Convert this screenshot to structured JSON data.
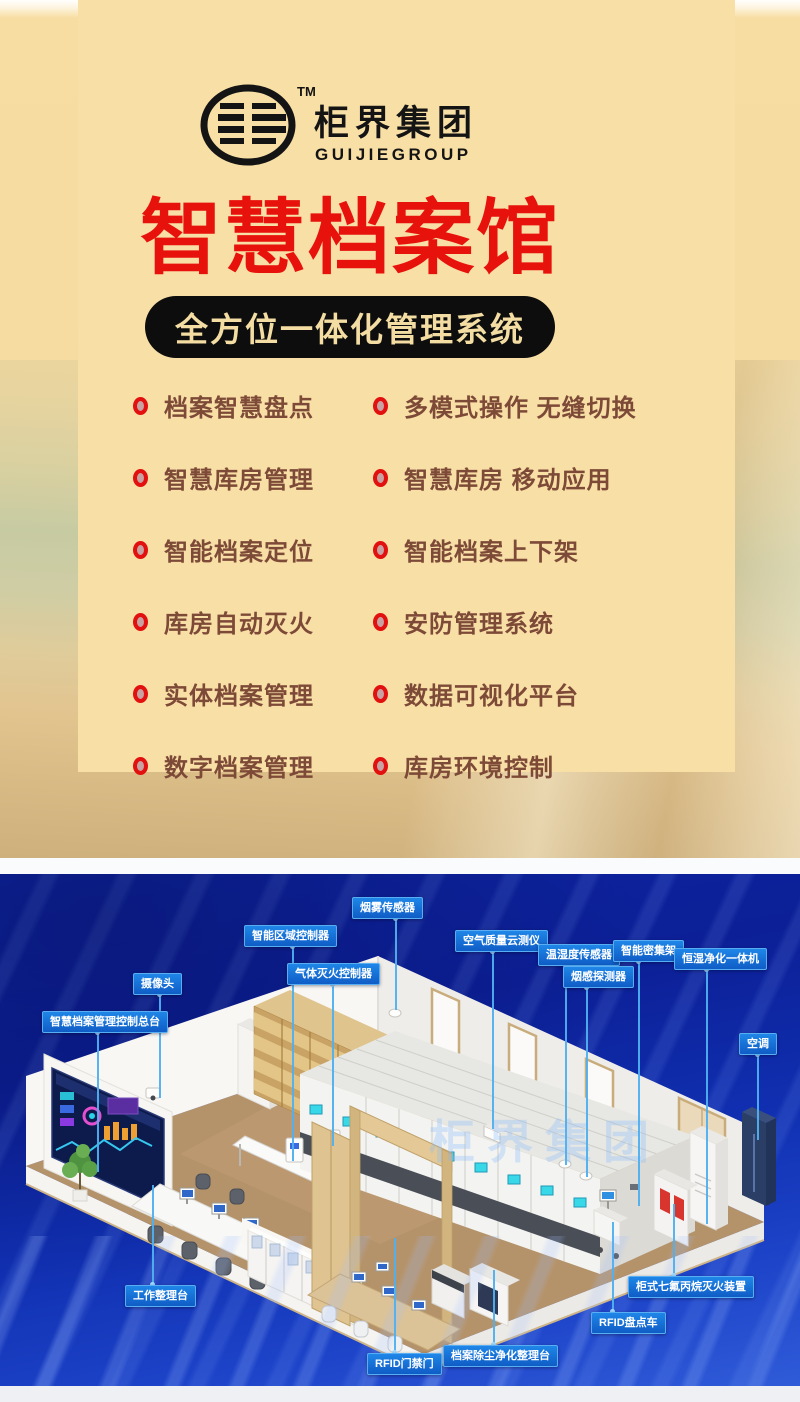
{
  "brand": {
    "trademark": "TM",
    "name_cn": "柜界集团",
    "name_en": "GUIJIEGROUP"
  },
  "hero": {
    "title": "智慧档案馆",
    "subtitle": "全方位一体化管理系统",
    "features": {
      "left": [
        "档案智慧盘点",
        "智慧库房管理",
        "智能档案定位",
        "库房自动灭火",
        "实体档案管理",
        "数字档案管理"
      ],
      "right": [
        "多模式操作 无缝切换",
        "智慧库房 移动应用",
        "智能档案上下架",
        "安防管理系统",
        "数据可视化平台",
        "库房环境控制"
      ]
    }
  },
  "scene": {
    "watermark": "柜界集团",
    "labels": [
      {
        "id": "smoke-sensor",
        "text": "烟雾传感器",
        "x": 352,
        "y": 897,
        "lx": 395,
        "dir": "down",
        "len": 92
      },
      {
        "id": "zone-controller",
        "text": "智能区域控制器",
        "x": 244,
        "y": 925,
        "lx": 292,
        "dir": "down",
        "len": 215
      },
      {
        "id": "gas-fire-controller",
        "text": "气体灭火控制器",
        "x": 287,
        "y": 963,
        "lx": 332,
        "dir": "down",
        "len": 162
      },
      {
        "id": "air-quality-monitor",
        "text": "空气质量云测仪",
        "x": 455,
        "y": 930,
        "lx": 492,
        "dir": "down",
        "len": 178
      },
      {
        "id": "temp-humidity-sensor",
        "text": "温湿度传感器",
        "x": 538,
        "y": 944,
        "lx": 565,
        "dir": "down",
        "len": 200
      },
      {
        "id": "smoke-detector",
        "text": "烟感探测器",
        "x": 563,
        "y": 966,
        "lx": 586,
        "dir": "down",
        "len": 190
      },
      {
        "id": "smart-compact-shelving",
        "text": "智能密集架",
        "x": 613,
        "y": 940,
        "lx": 638,
        "dir": "down",
        "len": 245
      },
      {
        "id": "humidity-purifier-unit",
        "text": "恒湿净化一体机",
        "x": 674,
        "y": 948,
        "lx": 706,
        "dir": "down",
        "len": 255
      },
      {
        "id": "air-conditioner",
        "text": "空调",
        "x": 739,
        "y": 1033,
        "lx": 757,
        "dir": "down",
        "len": 86
      },
      {
        "id": "camera",
        "text": "摄像头",
        "x": 133,
        "y": 973,
        "lx": 159,
        "dir": "down",
        "len": 104
      },
      {
        "id": "control-console",
        "text": "智慧档案管理控制总台",
        "x": 42,
        "y": 1011,
        "lx": 97,
        "dir": "down",
        "len": 140
      },
      {
        "id": "work-table",
        "text": "工作整理台",
        "x": 125,
        "y": 1285,
        "lx": 152,
        "dir": "up",
        "len": 100
      },
      {
        "id": "rfid-gate",
        "text": "RFID门禁门",
        "x": 367,
        "y": 1353,
        "lx": 394,
        "dir": "up",
        "len": 115
      },
      {
        "id": "dust-cleaning-table",
        "text": "档案除尘净化整理台",
        "x": 443,
        "y": 1345,
        "lx": 493,
        "dir": "up",
        "len": 75
      },
      {
        "id": "rfid-inventory-cart",
        "text": "RFID盘点车",
        "x": 591,
        "y": 1312,
        "lx": 612,
        "dir": "up",
        "len": 90
      },
      {
        "id": "cabinet-fire-extinguisher",
        "text": "柜式七氟丙烷灭火装置",
        "x": 628,
        "y": 1276,
        "lx": 673,
        "dir": "up",
        "len": 72
      }
    ]
  },
  "colors": {
    "title_red": "#e8120c",
    "pill_bg": "#0d0d0d",
    "pill_text": "#f3dda2",
    "feature_text": "#7d4a38",
    "bullet_red": "#e2100e",
    "label_blue": "#1474dc",
    "scene_bg": "#0d23a0"
  }
}
